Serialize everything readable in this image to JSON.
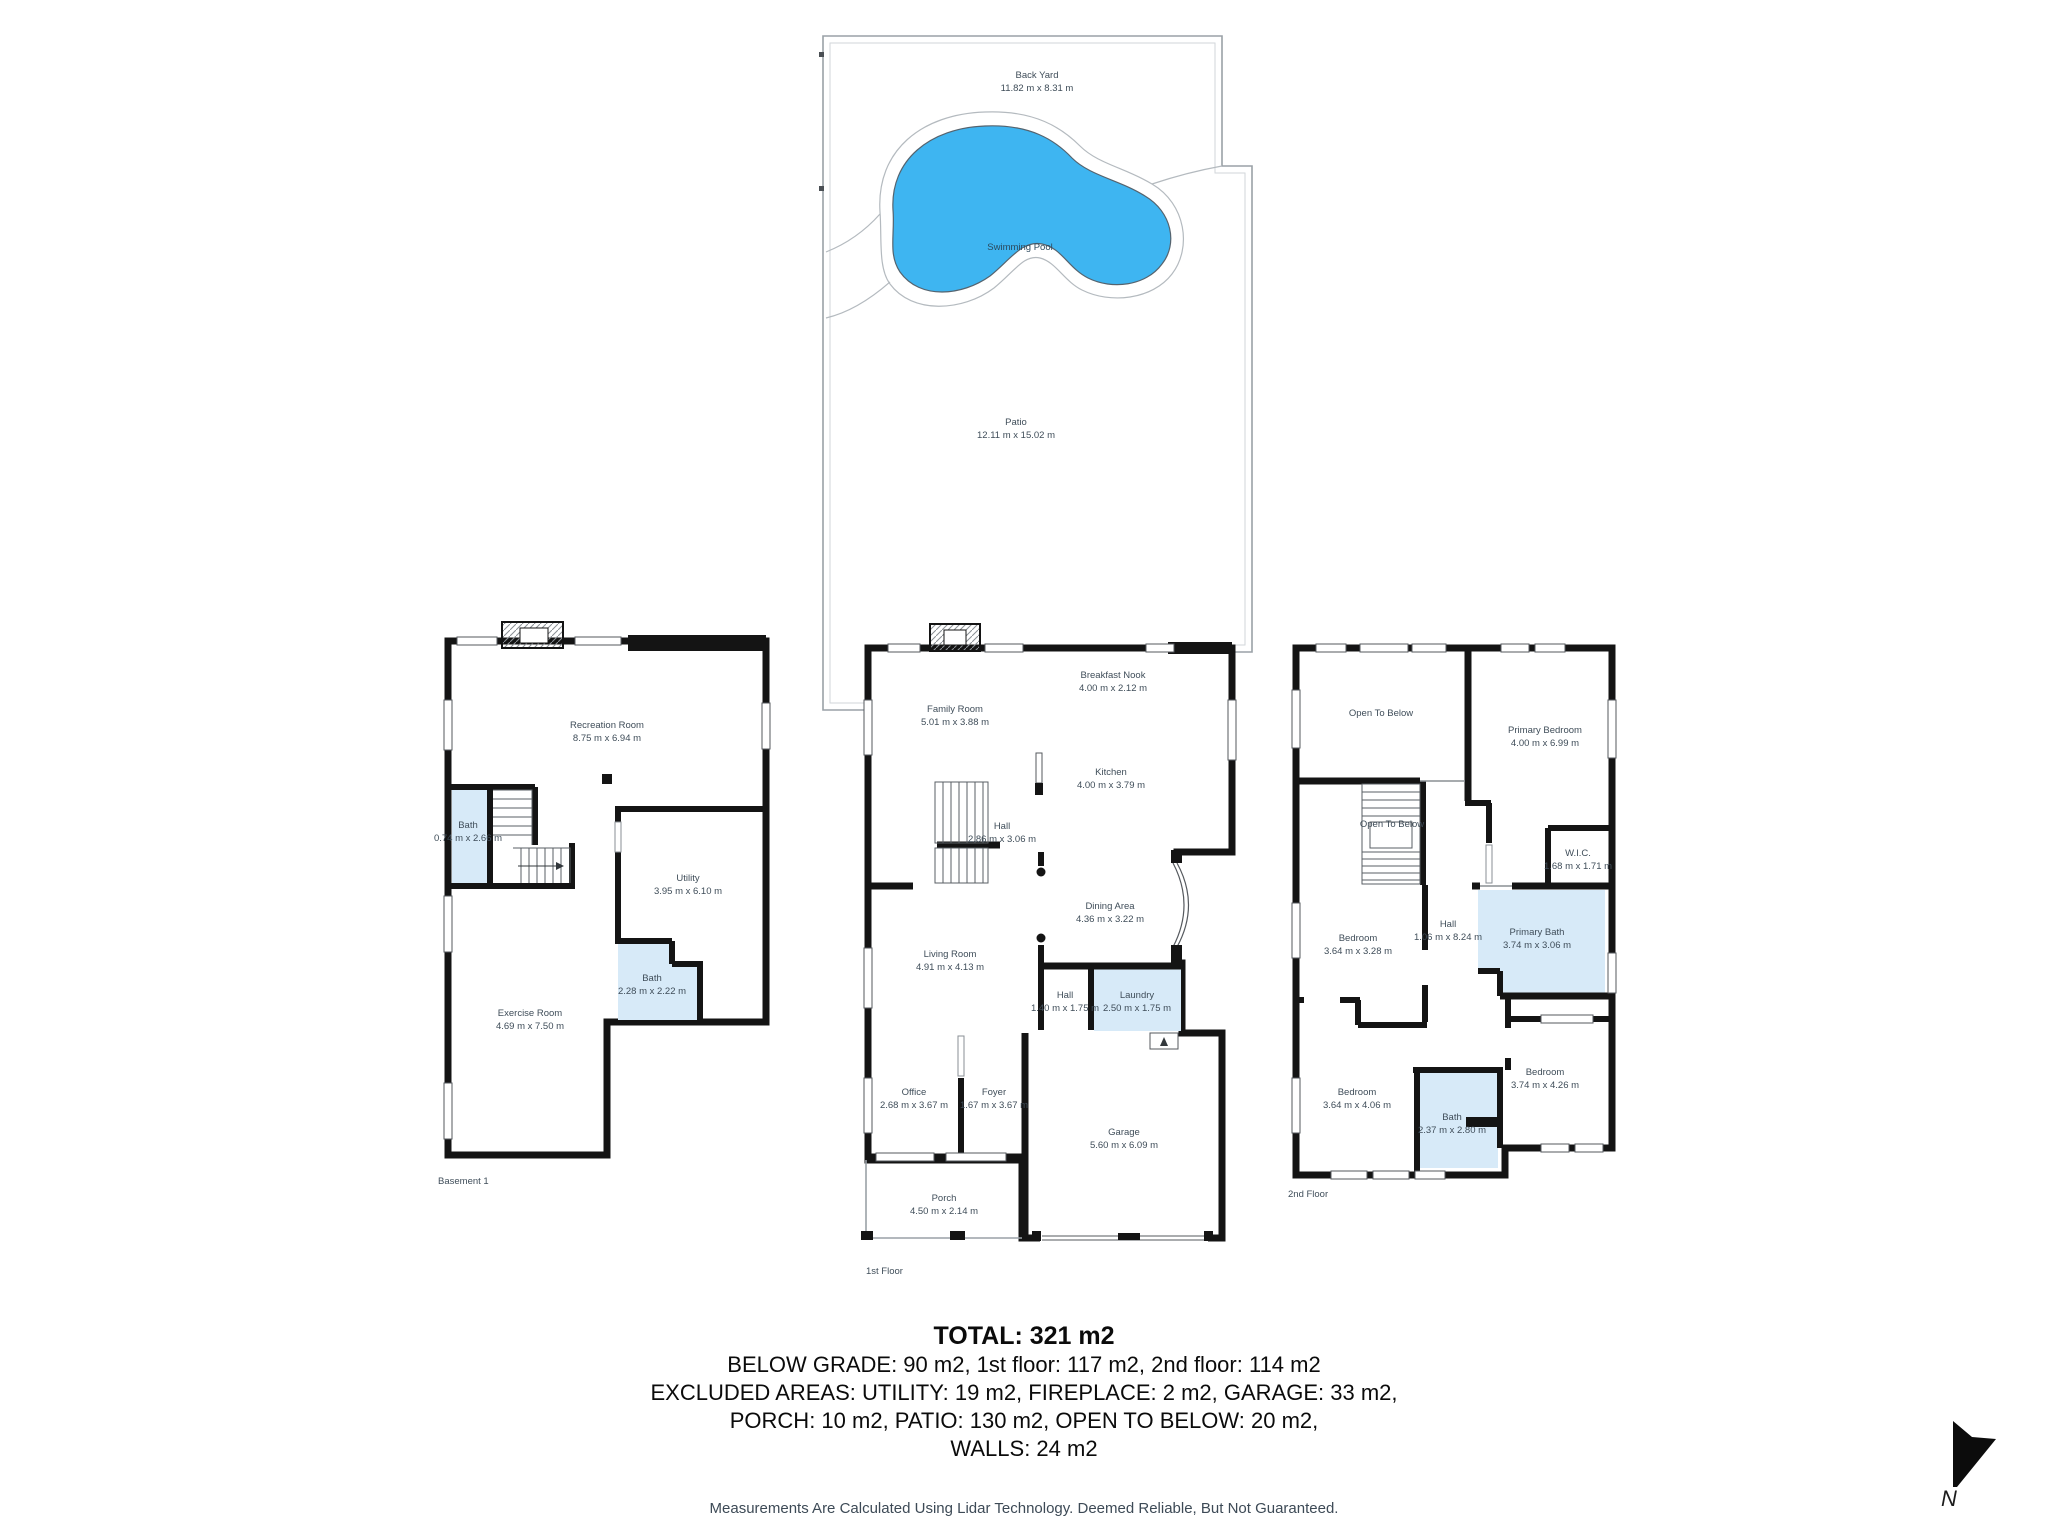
{
  "yard": {
    "back_yard_label": "Back Yard",
    "back_yard_dims": "11.82 m x 8.31 m",
    "pool_label": "Swimming Pool",
    "patio_label": "Patio",
    "patio_dims": "12.11 m x 15.02 m"
  },
  "floors": [
    {
      "title": "Basement 1",
      "rooms": [
        {
          "name": "Recreation Room",
          "dims": "8.75 m x 6.94 m"
        },
        {
          "name": "Bath",
          "dims": "0.74 m x 2.66 m"
        },
        {
          "name": "Utility",
          "dims": "3.95 m x 6.10 m"
        },
        {
          "name": "Bath",
          "dims": "2.28 m x 2.22 m"
        },
        {
          "name": "Exercise Room",
          "dims": "4.69 m x 7.50 m"
        }
      ]
    },
    {
      "title": "1st Floor",
      "rooms": [
        {
          "name": "Family Room",
          "dims": "5.01 m x 3.88 m"
        },
        {
          "name": "Breakfast Nook",
          "dims": "4.00 m x 2.12 m"
        },
        {
          "name": "Kitchen",
          "dims": "4.00 m x 3.79 m"
        },
        {
          "name": "Hall",
          "dims": "2.86 m x 3.06 m"
        },
        {
          "name": "Dining Area",
          "dims": "4.36 m x 3.22 m"
        },
        {
          "name": "Living Room",
          "dims": "4.91 m x 4.13 m"
        },
        {
          "name": "Hall",
          "dims": "1.40 m x 1.75 m"
        },
        {
          "name": "Laundry",
          "dims": "2.50 m x 1.75 m"
        },
        {
          "name": "Office",
          "dims": "2.68 m x 3.67 m"
        },
        {
          "name": "Foyer",
          "dims": "1.67 m x 3.67 m"
        },
        {
          "name": "Garage",
          "dims": "5.60 m x 6.09 m"
        },
        {
          "name": "Porch",
          "dims": "4.50 m x 2.14 m"
        }
      ]
    },
    {
      "title": "2nd Floor",
      "rooms": [
        {
          "name": "Open To Below",
          "dims": ""
        },
        {
          "name": "Primary Bedroom",
          "dims": "4.00 m x 6.99 m"
        },
        {
          "name": "Open To Below",
          "dims": ""
        },
        {
          "name": "W.I.C.",
          "dims": "1.68 m x 1.71 m"
        },
        {
          "name": "Bedroom",
          "dims": "3.64 m x 3.28 m"
        },
        {
          "name": "Hall",
          "dims": "1.06 m x 8.24 m"
        },
        {
          "name": "Primary Bath",
          "dims": "3.74 m x 3.06 m"
        },
        {
          "name": "Bedroom",
          "dims": "3.64 m x 4.06 m"
        },
        {
          "name": "Bath",
          "dims": "2.37 m x 2.80 m"
        },
        {
          "name": "Bedroom",
          "dims": "3.74 m x 4.26 m"
        }
      ]
    }
  ],
  "summary": {
    "total": "TOTAL: 321 m2",
    "line1": "BELOW GRADE: 90 m2, 1st floor: 117 m2, 2nd floor: 114 m2",
    "line2": "EXCLUDED AREAS: UTILITY: 19 m2, FIREPLACE: 2 m2, GARAGE: 33 m2,",
    "line3": "PORCH: 10 m2, PATIO: 130 m2, OPEN TO BELOW: 20 m2,",
    "line4": "WALLS: 24 m2"
  },
  "footer": "Measurements Are Calculated Using Lidar Technology. Deemed Reliable, But Not Guaranteed.",
  "compass": {
    "label": "N"
  },
  "colors": {
    "pool_fill": "#3eb5f1",
    "bath_fill": "#d7eaf8",
    "wall": "#141414",
    "label_text": "#3f4d59",
    "yard_line": "#9aa1a7"
  }
}
